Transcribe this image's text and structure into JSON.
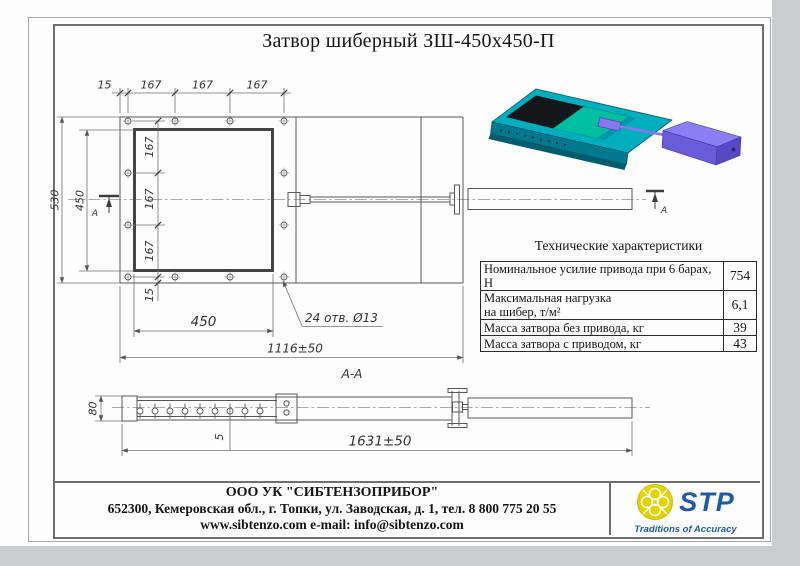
{
  "page": {
    "background": "#cbced0",
    "paper": "#fdfdfd",
    "line_color": "#565656"
  },
  "title": "Затвор шиберный ЗШ-450х450-П",
  "top_view": {
    "dim_edge_top": "15",
    "dim_pitch_1": "167",
    "dim_pitch_2": "167",
    "dim_pitch_3": "167",
    "dim_overall_height": "530",
    "dim_opening_height": "450",
    "dim_pitch_v1": "167",
    "dim_pitch_v2": "167",
    "dim_pitch_v3": "167",
    "dim_edge_bottom": "15",
    "dim_opening_width": "450",
    "dim_body_length": "1116±50",
    "holes_note": "24 отв. Ø13",
    "section_marker": "А"
  },
  "section_view": {
    "label": "А-А",
    "dim_height": "80",
    "dim_plate_thickness": "5",
    "dim_overall_length": "1631±50"
  },
  "render3d": {
    "colors": {
      "body": "#00aebe",
      "body_side": "#01798f",
      "body_lip": "#015c6d",
      "plate": "#00bfa0",
      "rail": "#0196ab",
      "opening": "#15181a",
      "actuator_top": "#8b7df2",
      "actuator_front": "#6a5cd8",
      "actuator_side": "#5649c6",
      "rod": "#8678e8"
    }
  },
  "spec_table": {
    "title": "Технические характеристики",
    "rows": [
      {
        "label": "Номинальное усилие привода при 6 барах, Н",
        "value": "754"
      },
      {
        "label": "Максимальная нагрузка\nна шибер, т/м²",
        "value": "6,1"
      },
      {
        "label": "Масса затвора без привода, кг",
        "value": "39"
      },
      {
        "label": "Масса затвора с приводом, кг",
        "value": "43"
      }
    ]
  },
  "footer": {
    "company": "ООО УК \"СИБТЕНЗОПРИБОР\"",
    "address": "652300, Кемеровская обл., г. Топки, ул. Заводская, д. 1, тел. 8 800 775 20 55",
    "contacts": "www.sibtenzo.com e-mail: info@sibtenzo.com",
    "logo": {
      "name": "STP",
      "tagline": "Traditions of Accuracy",
      "accent_color": "#1e5aa8",
      "emblem_color": "#e3d400"
    }
  }
}
